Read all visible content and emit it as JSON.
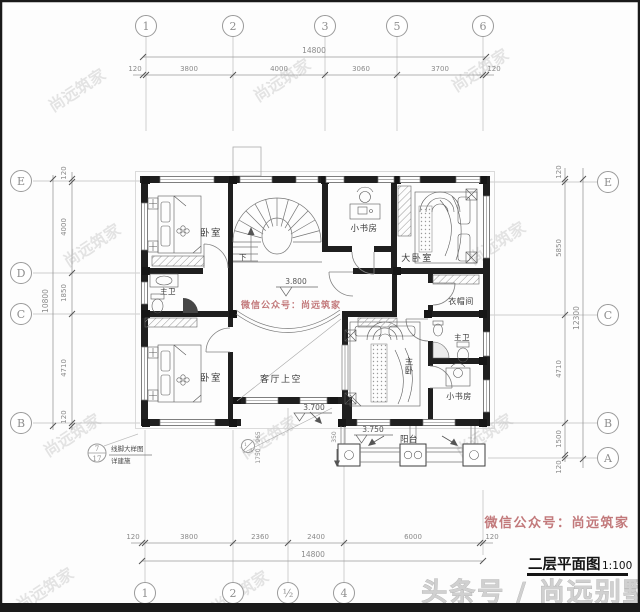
{
  "meta": {
    "accent_red": "#c2797b",
    "wall_color": "#1f1f1f",
    "dim_color": "#8a8a8a",
    "watermark_color": "#c9c9c9"
  },
  "title_block": {
    "name": "二层平面图",
    "scale": "1:100"
  },
  "watermarks": {
    "wechat": "微信公众号：尚远筑家",
    "brand": "尚远筑家",
    "footer": "头条号 / 尚远别墅"
  },
  "grid": {
    "top": [
      "1",
      "2",
      "3",
      "5",
      "6"
    ],
    "bottom": [
      "1",
      "2",
      "½",
      "4"
    ],
    "left": [
      "E",
      "D",
      "C",
      "B"
    ],
    "right": [
      "E",
      "C",
      "B",
      "A"
    ],
    "minor": {
      "num": "1",
      "letter": "A"
    }
  },
  "dims": {
    "top": {
      "overall": "14800",
      "segments": [
        "120",
        "3800",
        "4000",
        "3060",
        "3700",
        "120"
      ]
    },
    "bottom": {
      "overall": "14800",
      "segments": [
        "120",
        "3800",
        "2360",
        "2400",
        "6000",
        "120"
      ]
    },
    "left": {
      "overall": "10800",
      "segments": [
        "120",
        "4000",
        "1850",
        "4710",
        "120"
      ]
    },
    "right": {
      "overall": "12300",
      "segments": [
        "120",
        "5850",
        "4710",
        "1500",
        "120"
      ]
    },
    "local": [
      "965",
      "1750",
      "350"
    ]
  },
  "levels": {
    "hall": "3.800",
    "void": "3.700",
    "balcony": "3.750"
  },
  "rooms": {
    "bedroom1": "卧室",
    "study1": "小书房",
    "master1": "大卧室",
    "bath1": "主卫",
    "cloak": "衣帽间",
    "bedroom2": "卧室",
    "void": "客厅上空",
    "master2": "主卧",
    "bath2": "主卫",
    "study2": "小书房",
    "balcony": "阳台"
  },
  "stair": {
    "down": "下"
  },
  "callout": {
    "num": "7",
    "sheet": "17",
    "line1": "线脚大样图",
    "line2": "详建施"
  }
}
